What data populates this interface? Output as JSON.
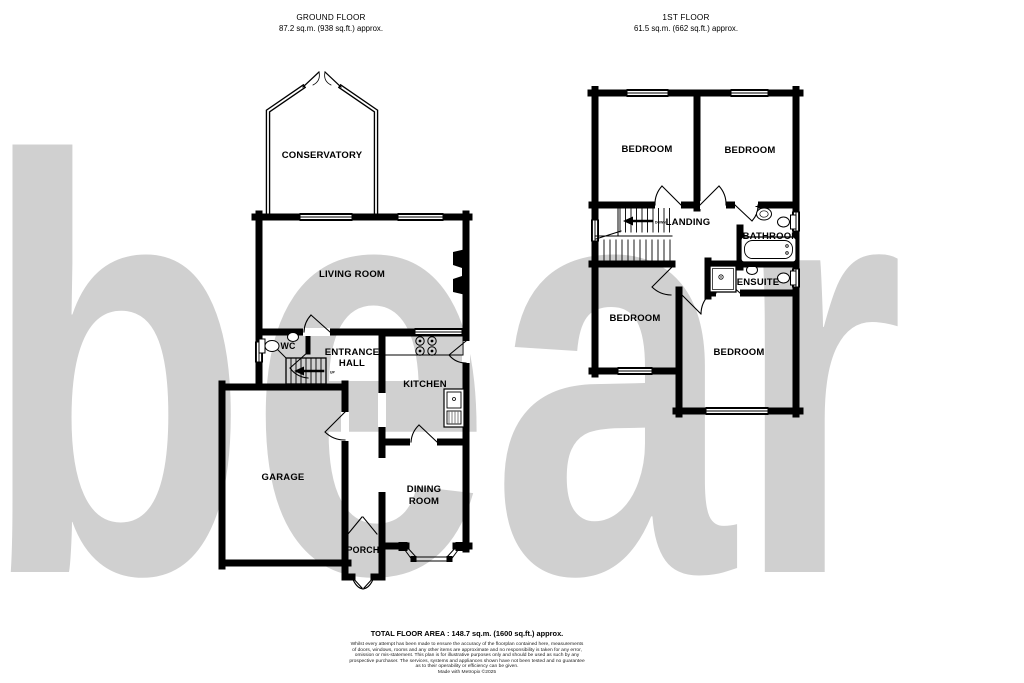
{
  "watermark": {
    "text": "bear",
    "color": "#d0d0d0"
  },
  "ground_floor": {
    "title": "GROUND FLOOR",
    "area": "87.2 sq.m. (938 sq.ft.) approx.",
    "rooms": {
      "conservatory": "CONSERVATORY",
      "living_room": "LIVING ROOM",
      "wc": "WC",
      "entrance_hall_line1": "ENTRANCE",
      "entrance_hall_line2": "HALL",
      "kitchen": "KITCHEN",
      "garage": "GARAGE",
      "dining_room_line1": "DINING",
      "dining_room_line2": "ROOM",
      "porch": "PORCH"
    },
    "stair_direction": "UP"
  },
  "first_floor": {
    "title": "1ST FLOOR",
    "area": "61.5 sq.m. (662 sq.ft.) approx.",
    "rooms": {
      "bedroom_top_left": "BEDROOM",
      "bedroom_top_right": "BEDROOM",
      "landing": "LANDING",
      "bathroom": "BATHROOM",
      "ensuite": "ENSUITE",
      "bedroom_bottom_left": "BEDROOM",
      "bedroom_bottom_right": "BEDROOM"
    },
    "stair_direction": "DOWN"
  },
  "footer": {
    "total_area": "TOTAL FLOOR AREA : 148.7 sq.m. (1600 sq.ft.) approx.",
    "disclaimer_lines": [
      "Whilst every attempt has been made to ensure the accuracy of the floorplan contained here, measurements",
      "of doors, windows, rooms and any other items are approximate and no responsibility is taken for any error,",
      "omission or mis-statement. This plan is for illustrative purposes only and should be used as such by any",
      "prospective purchaser. The services, systems and appliances shown have not been tested and no guarantee",
      "as to their operability or efficiency can be given."
    ],
    "credit": "Made with Metropix ©2025"
  }
}
